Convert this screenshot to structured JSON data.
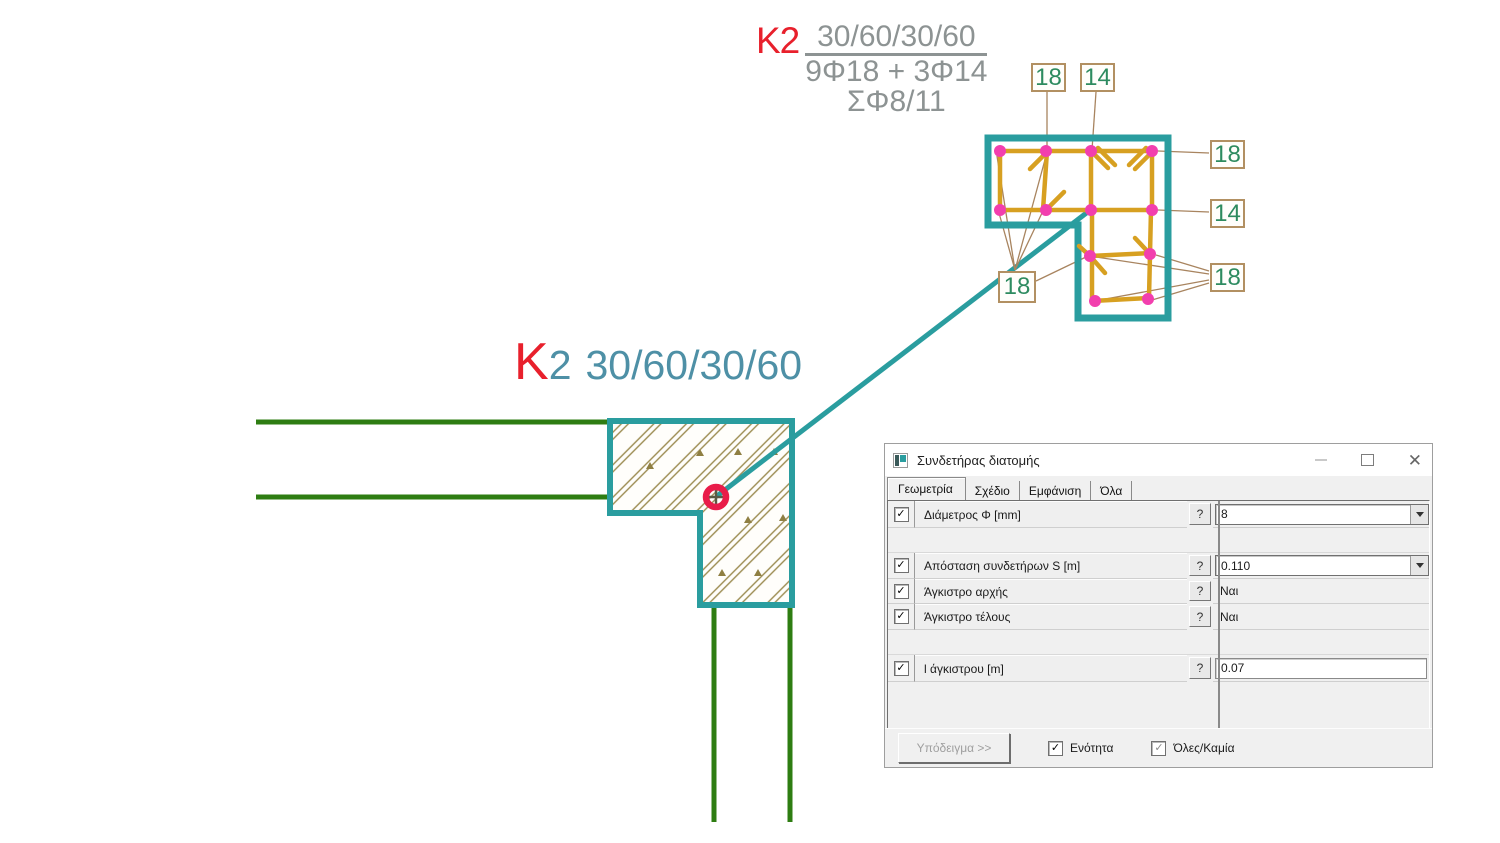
{
  "drawing": {
    "top_annotation": {
      "mark": "K2",
      "dimensions": "30/60/30/60",
      "reinforcement": "9Φ18 + 3Φ14",
      "stirrups": "ΣΦ8/11"
    },
    "plan_annotation": {
      "mark_letter": "K",
      "mark_number": "2",
      "dimensions": "30/60/30/60"
    },
    "section_markers": {
      "top_left": "18",
      "top_right": "14",
      "right_upper": "18",
      "right_lower": "14",
      "bottom_left": "18",
      "bottom_right": "18"
    },
    "colors": {
      "outline_teal": "#2a9d9f",
      "text_teal": "#4e90a6",
      "mark_red": "#e8202c",
      "beam_green": "#2e7d12",
      "stirrup_orange": "#d7a021",
      "rebar_pink": "#f23fae",
      "leader_tan": "#a8845f",
      "marker_green": "#2e8b5f",
      "hatch_olive": "#9b8b50",
      "annotation_gray": "#8d9393"
    }
  },
  "dialog": {
    "title": "Συνδετήρας διατομής",
    "tabs": {
      "tab1": "Γεωμετρία",
      "tab2": "Σχέδιο",
      "tab3": "Εμφάνιση",
      "tab4": "Όλα"
    },
    "rows": [
      {
        "label": "Διάμετρος Φ [mm]",
        "value": "8"
      },
      {
        "label": "Απόσταση συνδετήρων S [m]",
        "value": "0.110"
      },
      {
        "label": "Άγκιστρο αρχής",
        "value": "Ναι"
      },
      {
        "label": "Άγκιστρο τέλους",
        "value": "Ναι"
      },
      {
        "label": "l άγκιστρου [m]",
        "value": "0.07"
      }
    ],
    "footer": {
      "template_button": "Υπόδειγμα >>",
      "section_checkbox": "Ενότητα",
      "all_none_checkbox": "Όλες/Καμία"
    },
    "icons": {
      "help": "?",
      "check": "✓",
      "close": "✕"
    }
  }
}
